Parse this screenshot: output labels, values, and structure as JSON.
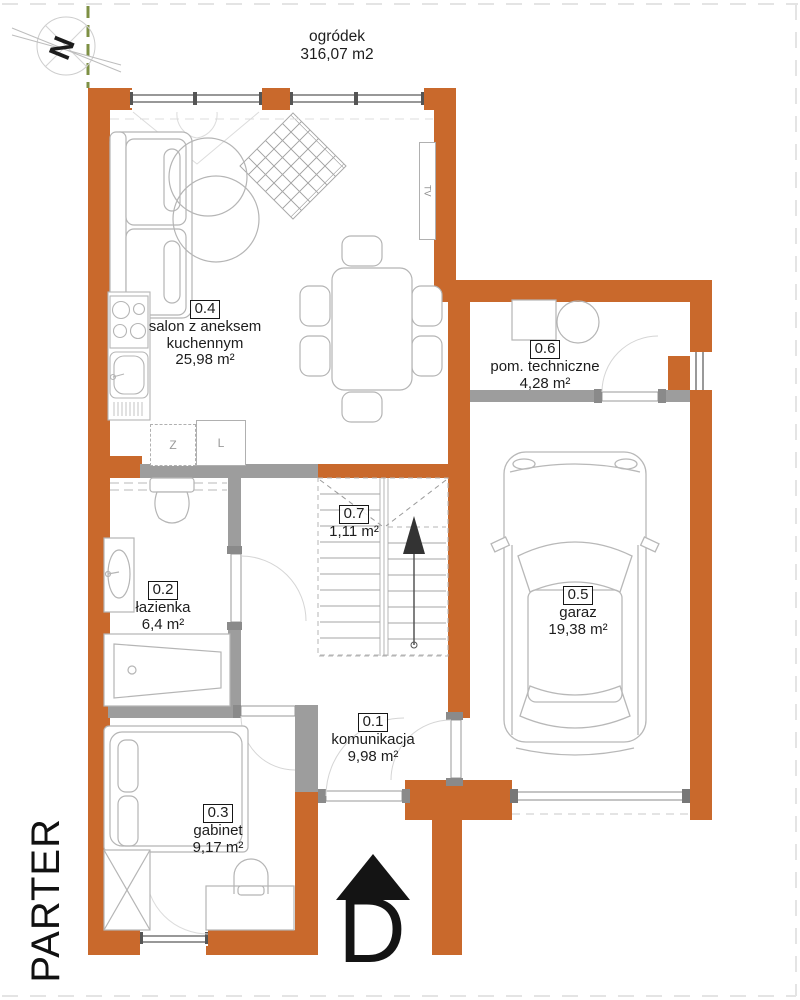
{
  "plan": {
    "floor_label": "PARTER",
    "entrance_marker": "D",
    "compass_letter": "N",
    "garden": {
      "name": "ogródek",
      "area": "316,07 m2"
    },
    "rooms": {
      "r01": {
        "id": "0.1",
        "name": "komunikacja",
        "area": "9,98 m²"
      },
      "r02": {
        "id": "0.2",
        "name": "łazienka",
        "area": "6,4 m²"
      },
      "r03": {
        "id": "0.3",
        "name": "gabinet",
        "area": "9,17 m²"
      },
      "r04": {
        "id": "0.4",
        "name1": "salon z aneksem",
        "name2": "kuchennym",
        "area": "25,98 m²"
      },
      "r05": {
        "id": "0.5",
        "name": "garaz",
        "area": "19,38 m²"
      },
      "r06": {
        "id": "0.6",
        "name": "pom. techniczne",
        "area": "4,28 m²"
      },
      "r07": {
        "id": "0.7",
        "area": "1,11 m²"
      }
    },
    "appliances": {
      "dishwasher": "Z",
      "fridge": "L",
      "tv": "TV"
    }
  },
  "colors": {
    "exterior_wall": "#c9692c",
    "interior_wall": "#9d9d9d",
    "furniture_line": "#b5b5b5",
    "plot_boundary_green": "#7e9044"
  }
}
